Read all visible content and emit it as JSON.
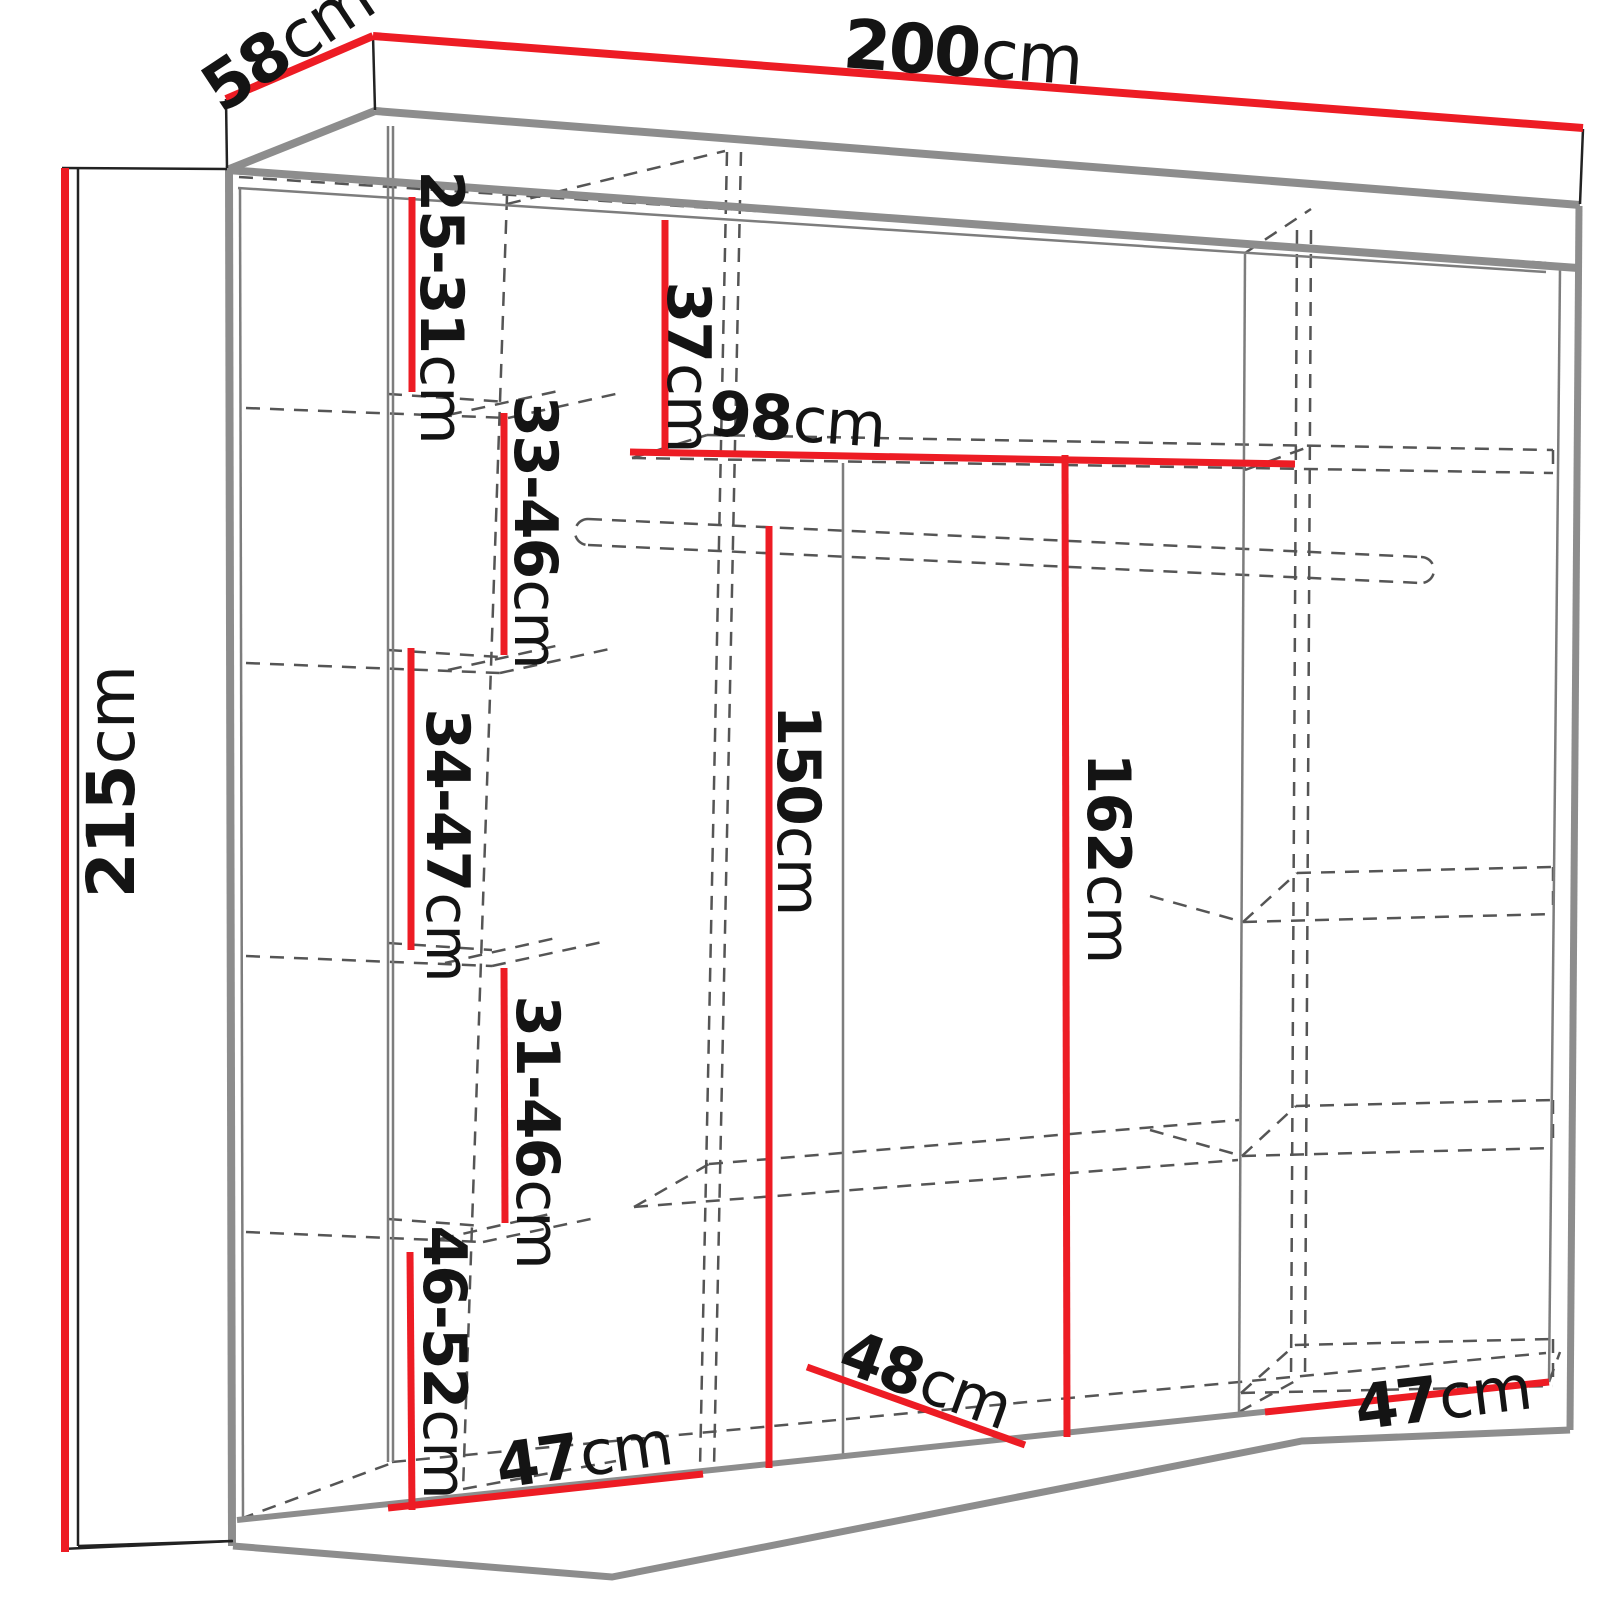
{
  "title": "wardrobe-dimension-diagram",
  "colors": {
    "dimension_line": "#ed1c24",
    "structure_line": "#8d8d8d",
    "hidden_line": "#555555",
    "text": "#141414",
    "background": "#ffffff"
  },
  "labels": {
    "w200": {
      "value": "200",
      "unit": "cm"
    },
    "d58": {
      "value": "58",
      "unit": "cm"
    },
    "h215": {
      "value": "215",
      "unit": "cm"
    },
    "g2531": {
      "value": "25-31",
      "unit": "cm"
    },
    "g3346": {
      "value": "33-46",
      "unit": "cm"
    },
    "g3447": {
      "value": "34-47",
      "unit": "cm"
    },
    "g3146": {
      "value": "31-46",
      "unit": "cm"
    },
    "g4652": {
      "value": "46-52",
      "unit": "cm"
    },
    "g37": {
      "value": "37",
      "unit": "cm"
    },
    "g98": {
      "value": "98",
      "unit": "cm"
    },
    "g150": {
      "value": "150",
      "unit": "cm"
    },
    "g162": {
      "value": "162",
      "unit": "cm"
    },
    "g48": {
      "value": "48",
      "unit": "cm"
    },
    "g47l": {
      "value": "47",
      "unit": "cm"
    },
    "g47r": {
      "value": "47",
      "unit": "cm"
    }
  }
}
